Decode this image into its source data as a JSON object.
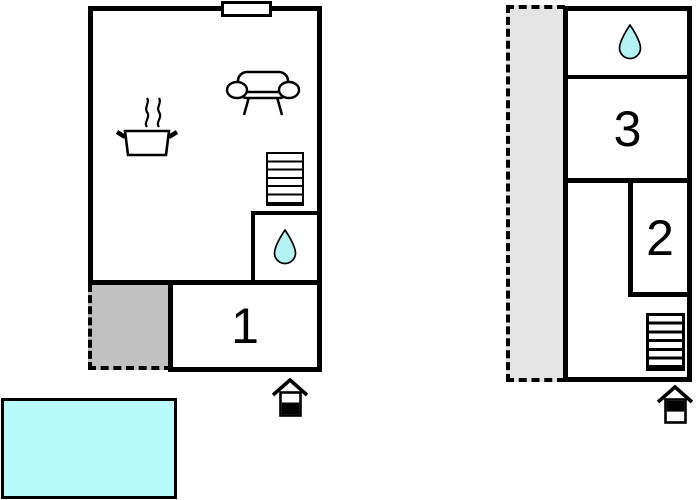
{
  "plans": {
    "ground_floor": {
      "name": "ground floor",
      "rooms": [
        {
          "id": "room-1",
          "label": "1"
        }
      ],
      "features": [
        "kitchen-pot",
        "steam",
        "sofa",
        "stairs-6-treads",
        "bathroom-water-drop",
        "chimney",
        "terrace-dashed-gray",
        "entrance-house",
        "pool"
      ]
    },
    "upper_floor": {
      "name": "upper floor",
      "rooms": [
        {
          "id": "room-3",
          "label": "3"
        },
        {
          "id": "room-2",
          "label": "2"
        }
      ],
      "features": [
        "bathroom-water-drop",
        "stairs-6-treads",
        "balcony-dashed-gray",
        "entrance-house"
      ]
    }
  },
  "colors": {
    "wall": "#000000",
    "terrace_fill": "#c1c1c1",
    "balcony_fill": "#e4e4e4",
    "water_drop_fill": "#b5f2f2",
    "pool_fill": "#b9fafa",
    "background": "#ffffff"
  }
}
